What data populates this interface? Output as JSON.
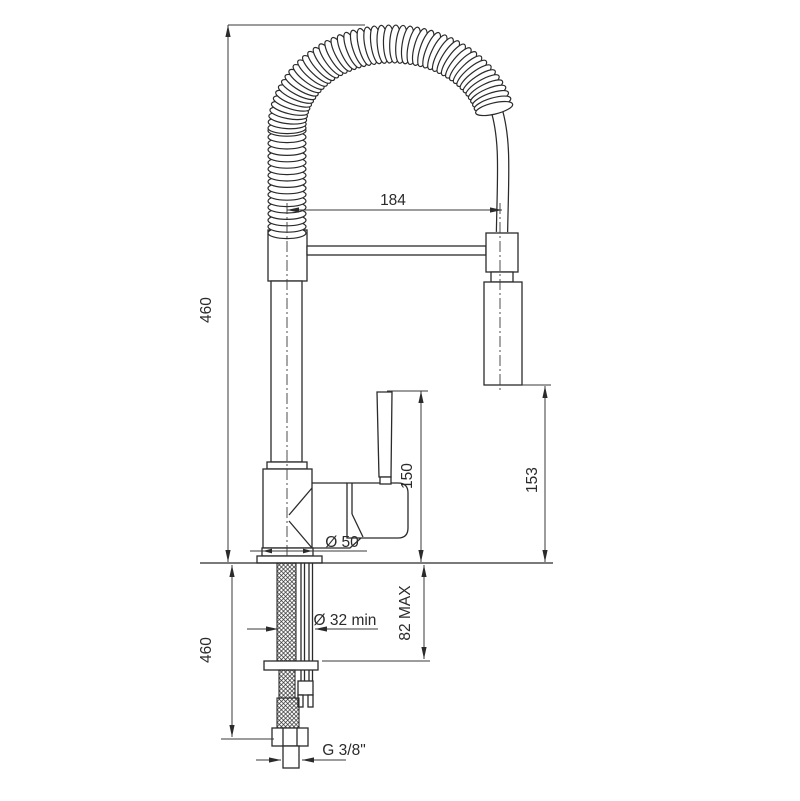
{
  "labels": {
    "spout_reach": "184",
    "height_top": "460",
    "handle_height": "150",
    "spray_height": "153",
    "base_diameter": "Ø 50",
    "hole_min_diameter": "Ø 32 min",
    "deck_max": "82 MAX",
    "hose_length": "460",
    "thread": "G 3/8\""
  }
}
